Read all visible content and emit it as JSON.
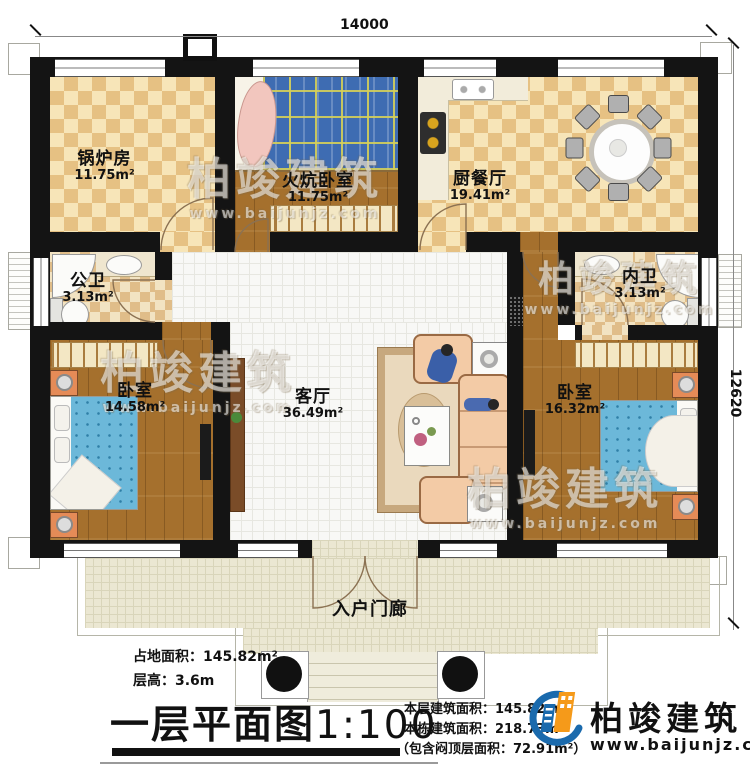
{
  "dimensions": {
    "width": "14000",
    "height": "12620"
  },
  "rooms": {
    "boiler_room": {
      "name": "锅炉房",
      "area": "11.75m²"
    },
    "kang_bedroom": {
      "name": "火炕卧室",
      "area": "11.75m²"
    },
    "kitchen_dining": {
      "name": "厨餐厅",
      "area": "19.41m²"
    },
    "public_bathroom": {
      "name": "公卫",
      "area": "3.13m²"
    },
    "private_bathroom": {
      "name": "内卫",
      "area": "3.13m²"
    },
    "bedroom_left": {
      "name": "卧室",
      "area": "14.58m²"
    },
    "living_room": {
      "name": "客厅",
      "area": "36.49m²"
    },
    "bedroom_right": {
      "name": "卧室",
      "area": "16.32m²"
    },
    "entrance_porch": {
      "name": "入户门廊"
    }
  },
  "annotations": {
    "land_area_label": "占地面积：145.82m²",
    "floor_height_label": "层高：3.6m",
    "title": "一层平面图",
    "scale": "1:100",
    "floor_area_label": "本层建筑面积：145.82m²",
    "total_area_label": "本栋建筑面积：218.73m²",
    "attic_area_label": "（包含闷顶层面积：72.91m²）"
  },
  "branding": {
    "company_name": "柏竣建筑",
    "website": "www.baijunjz.com"
  },
  "watermark": {
    "text": "柏竣建筑",
    "subtext": "www.baijunjz.com"
  },
  "colors": {
    "wall": "#141414",
    "tile_light": "#f7e5b8",
    "tile_dark": "#e6c183",
    "wood": "#a5702d",
    "kang_blue": "#3e6cb2",
    "bed_blue": "#6cb8d9",
    "porch": "#ebe7d2",
    "logo_blue": "#1a6aad",
    "logo_orange": "#f59a1a"
  }
}
